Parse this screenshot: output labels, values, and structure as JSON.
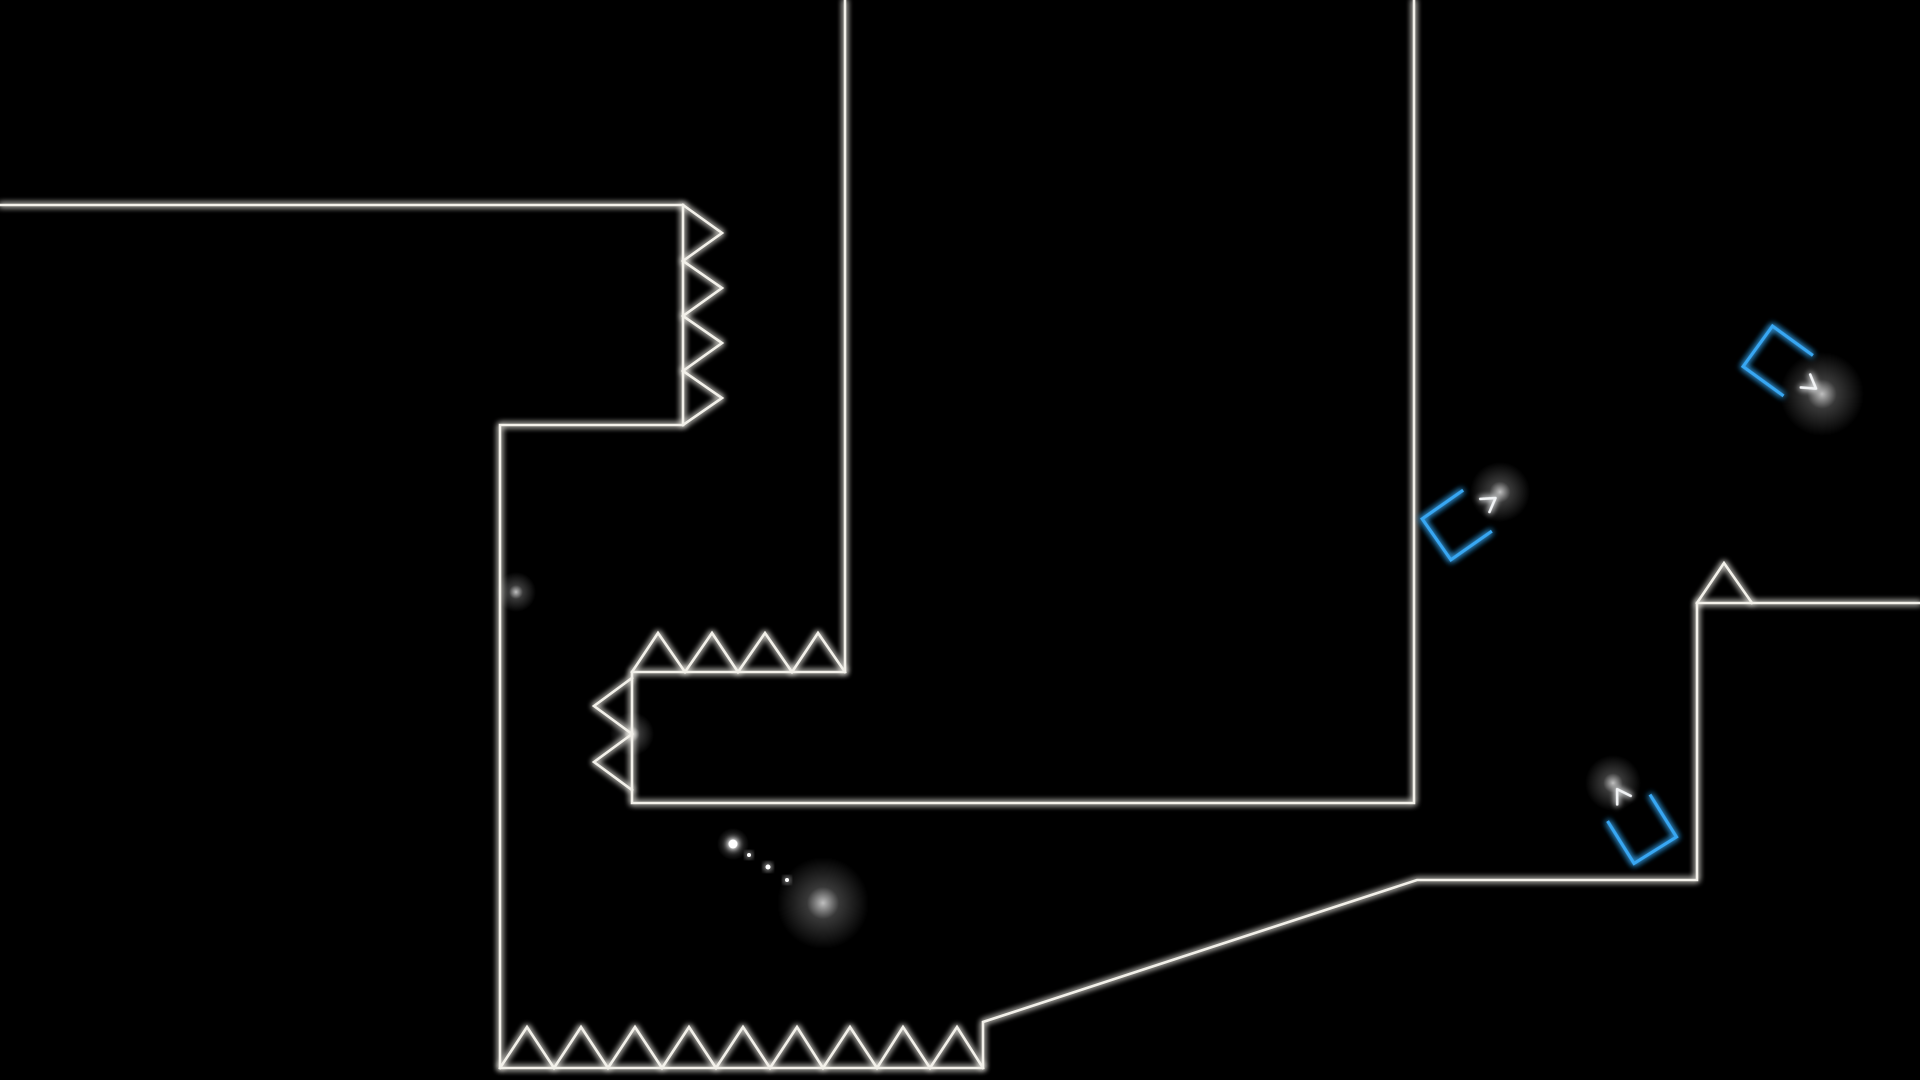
{
  "scene": {
    "width": 1920,
    "height": 1080,
    "background": "#000000"
  },
  "colors": {
    "background": "#000000",
    "wall": "#f3f1ea",
    "booster": "#38a7f3",
    "arrow": "#f2f4f6",
    "player": "#ffffff",
    "trail": "#ffffff"
  },
  "level": {
    "walls": [
      {
        "name": "wall-upper-left-floor-and-right-platform",
        "points": [
          [
            0,
            205
          ],
          [
            683,
            205
          ],
          [
            683,
            425
          ],
          [
            500,
            425
          ],
          [
            500,
            1068
          ],
          [
            983,
            1068
          ],
          [
            983,
            1022
          ],
          [
            1417,
            880
          ],
          [
            1697,
            880
          ],
          [
            1697,
            603
          ],
          [
            1920,
            603
          ]
        ]
      },
      {
        "name": "wall-center-tower",
        "points": [
          [
            845,
            0
          ],
          [
            845,
            672
          ],
          [
            632,
            672
          ],
          [
            632,
            803
          ],
          [
            1414,
            803
          ],
          [
            1414,
            0
          ]
        ]
      }
    ],
    "spike_strips": [
      {
        "name": "spikes-right-facing-on-upper-ledge",
        "points": [
          [
            683,
            205
          ],
          [
            722,
            233
          ],
          [
            683,
            261
          ],
          [
            722,
            288
          ],
          [
            683,
            316
          ],
          [
            722,
            343
          ],
          [
            683,
            371
          ],
          [
            722,
            398
          ],
          [
            683,
            425
          ]
        ]
      },
      {
        "name": "spikes-up-facing-on-tower-ledge",
        "points": [
          [
            632,
            672
          ],
          [
            658,
            633
          ],
          [
            685,
            672
          ],
          [
            712,
            633
          ],
          [
            738,
            672
          ],
          [
            765,
            633
          ],
          [
            792,
            672
          ],
          [
            818,
            633
          ],
          [
            845,
            672
          ]
        ]
      },
      {
        "name": "spikes-left-facing-on-tower-side",
        "points": [
          [
            632,
            678
          ],
          [
            594,
            706
          ],
          [
            632,
            734
          ],
          [
            594,
            762
          ],
          [
            632,
            790
          ]
        ]
      },
      {
        "name": "spikes-up-facing-on-bottom-floor",
        "points": [
          [
            500,
            1068
          ],
          [
            527,
            1027
          ],
          [
            554,
            1068
          ],
          [
            581,
            1027
          ],
          [
            608,
            1068
          ],
          [
            635,
            1027
          ],
          [
            662,
            1068
          ],
          [
            689,
            1027
          ],
          [
            716,
            1068
          ],
          [
            743,
            1027
          ],
          [
            770,
            1068
          ],
          [
            797,
            1027
          ],
          [
            823,
            1068
          ],
          [
            850,
            1027
          ],
          [
            877,
            1068
          ],
          [
            903,
            1027
          ],
          [
            930,
            1068
          ],
          [
            957,
            1027
          ],
          [
            983,
            1068
          ]
        ]
      },
      {
        "name": "spike-single-on-right-platform",
        "points": [
          [
            1697,
            603
          ],
          [
            1724,
            563
          ],
          [
            1752,
            603
          ]
        ]
      }
    ]
  },
  "booster_shape": {
    "size": 50,
    "bracket_path": "M 25 -25 L -25 -25 L -25 25 L 25 25",
    "arrow": {
      "shaft": [
        [
          -4,
          0
        ],
        [
          47,
          0
        ]
      ],
      "head": [
        [
          34,
          -8
        ],
        [
          47,
          0
        ],
        [
          34,
          8
        ]
      ]
    }
  },
  "boosters": [
    {
      "name": "booster-mid-right-up-right",
      "direction": "up-right",
      "x": 1457,
      "y": 525,
      "rotation": -35
    },
    {
      "name": "booster-top-right-down-right",
      "direction": "down-right",
      "x": 1778,
      "y": 361,
      "rotation": 36
    },
    {
      "name": "booster-bottom-right-up",
      "direction": "up",
      "x": 1642,
      "y": 829,
      "rotation": -122
    }
  ],
  "player": {
    "x": 823,
    "y": 903,
    "rotation": 43,
    "size": 34,
    "tick_overhang": 5
  },
  "trail_dots": [
    {
      "x": 733,
      "y": 844,
      "r": 4.5,
      "sparkle": true
    },
    {
      "x": 749,
      "y": 855,
      "r": 2
    },
    {
      "x": 768,
      "y": 867,
      "r": 2.5
    },
    {
      "x": 787,
      "y": 880,
      "r": 2
    }
  ],
  "blooms": [
    {
      "name": "bloom-arrow-tip-mid",
      "x": 1500,
      "y": 492,
      "r": 30
    },
    {
      "name": "bloom-arrow-tip-top-right",
      "x": 1822,
      "y": 394,
      "r": 42
    },
    {
      "name": "bloom-arrow-tip-bottom",
      "x": 1613,
      "y": 783,
      "r": 28
    },
    {
      "name": "bloom-player",
      "x": 823,
      "y": 903,
      "r": 46
    },
    {
      "name": "bloom-trail-dot",
      "x": 733,
      "y": 844,
      "r": 16
    },
    {
      "name": "bloom-spike-junction",
      "x": 632,
      "y": 734,
      "r": 22
    },
    {
      "name": "bloom-ledge-corner",
      "x": 516,
      "y": 592,
      "r": 20
    }
  ]
}
